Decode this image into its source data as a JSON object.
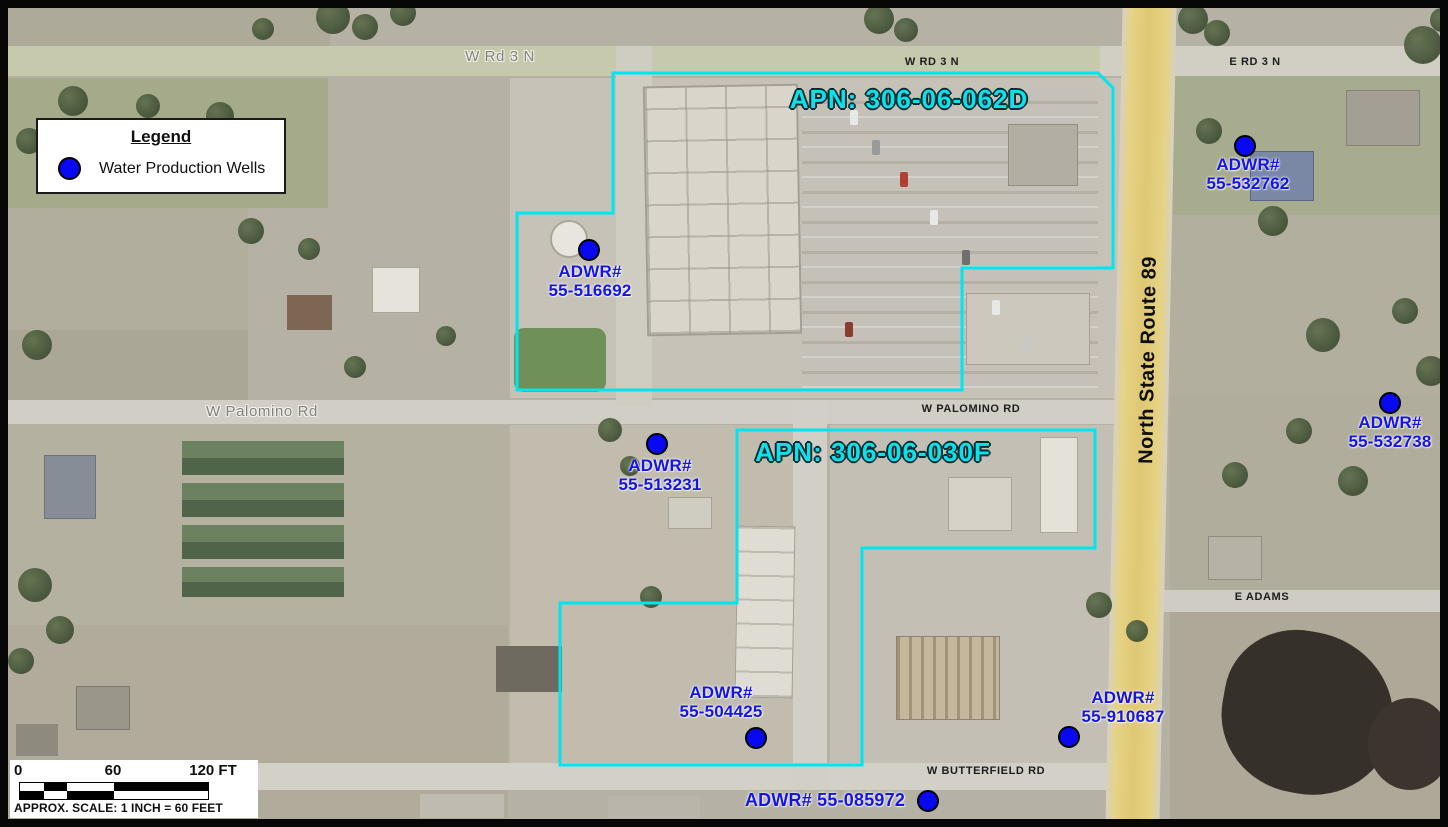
{
  "roads": {
    "w_rd_3_n_map_label": "W Rd 3 N",
    "w_rd_3_n_label": "W RD 3 N",
    "e_rd_3_n_label": "E RD 3 N",
    "w_palomino_map_label": "W Palomino Rd",
    "w_palomino_label": "W PALOMINO RD",
    "state_route_label": "North State Route 89",
    "e_adams_label": "E ADAMS",
    "w_butterfield_label": "W BUTTERFIELD RD"
  },
  "parcels": {
    "apn_062d": "APN: 306-06-062D",
    "apn_030f": "APN: 306-06-030F",
    "boundary_color": "#00e6f0"
  },
  "wells": {
    "marker_color": "#0808f2",
    "label_color": "#1414e8",
    "items": [
      {
        "line1": "ADWR#",
        "line2": "55-516692"
      },
      {
        "line1": "ADWR#",
        "line2": "55-532762"
      },
      {
        "line1": "ADWR#",
        "line2": "55-532738"
      },
      {
        "line1": "ADWR#",
        "line2": "55-513231"
      },
      {
        "line1": "ADWR#",
        "line2": "55-504425"
      },
      {
        "line1": "ADWR#",
        "line2": "55-910687"
      },
      {
        "label": "ADWR# 55-085972"
      }
    ]
  },
  "legend": {
    "title": "Legend",
    "item_label": "Water Production Wells"
  },
  "scale_bar": {
    "tick_start": "0",
    "tick_mid": "60",
    "tick_end": "120 FT",
    "caption": "APPROX. SCALE: 1 INCH = 60 FEET"
  }
}
